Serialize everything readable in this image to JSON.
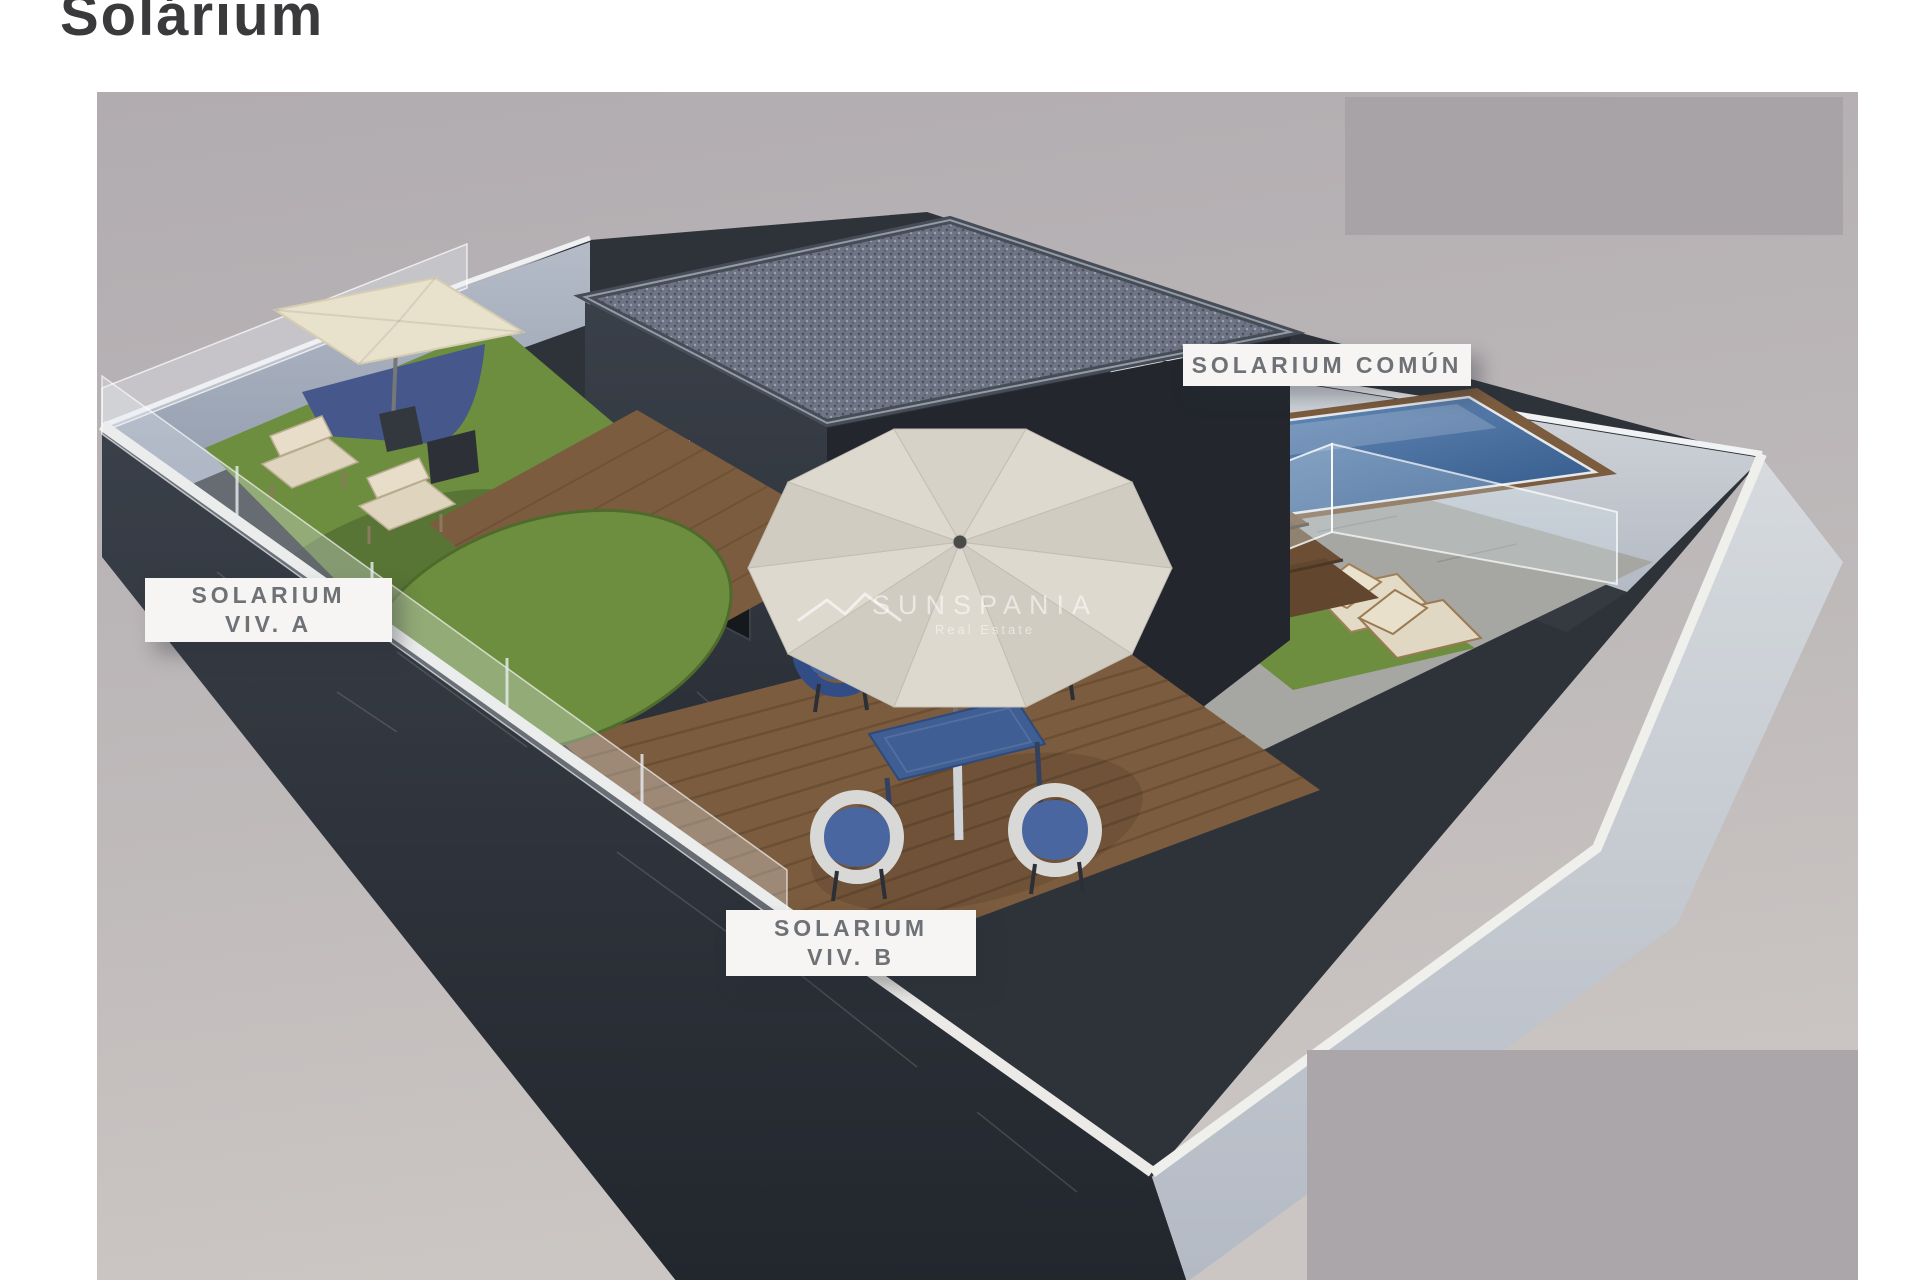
{
  "page": {
    "title": "Solárium"
  },
  "rendering": {
    "description": "3D aerial rendering of rooftop solarium terraces of a duplex villa",
    "labels": {
      "viv_a": {
        "line1": "SOLARIUM",
        "line2": "VIV. A"
      },
      "viv_b": {
        "line1": "SOLARIUM",
        "line2": "VIV. B"
      },
      "comun": {
        "text": "SOLARIUM COMÚN"
      }
    },
    "watermark": {
      "brand": "SUNSPANIA",
      "tagline": "Real Estate",
      "logo": "mountain-roof-logo-icon"
    },
    "palette": {
      "ground": "#bab5b6",
      "ground_light": "#cbc6c3",
      "overlay_patch": "#a9a4a8",
      "wall_dark": "#31363d",
      "wall_light": "#aeb7c4",
      "coping_white": "#eceae7",
      "roof_gravel": "#6f7585",
      "wood_deck": "#7c5c3e",
      "grass": "#6d8d3f",
      "pool_water": "#4c7fb3",
      "umbrella_cream": "#ded9cf",
      "parasol_beige": "#e8e1cc",
      "furniture_blue": "#3f5e94",
      "label_bg": "#f6f5f3",
      "label_text": "#6e7277",
      "title_text": "#3a3a3c"
    }
  }
}
